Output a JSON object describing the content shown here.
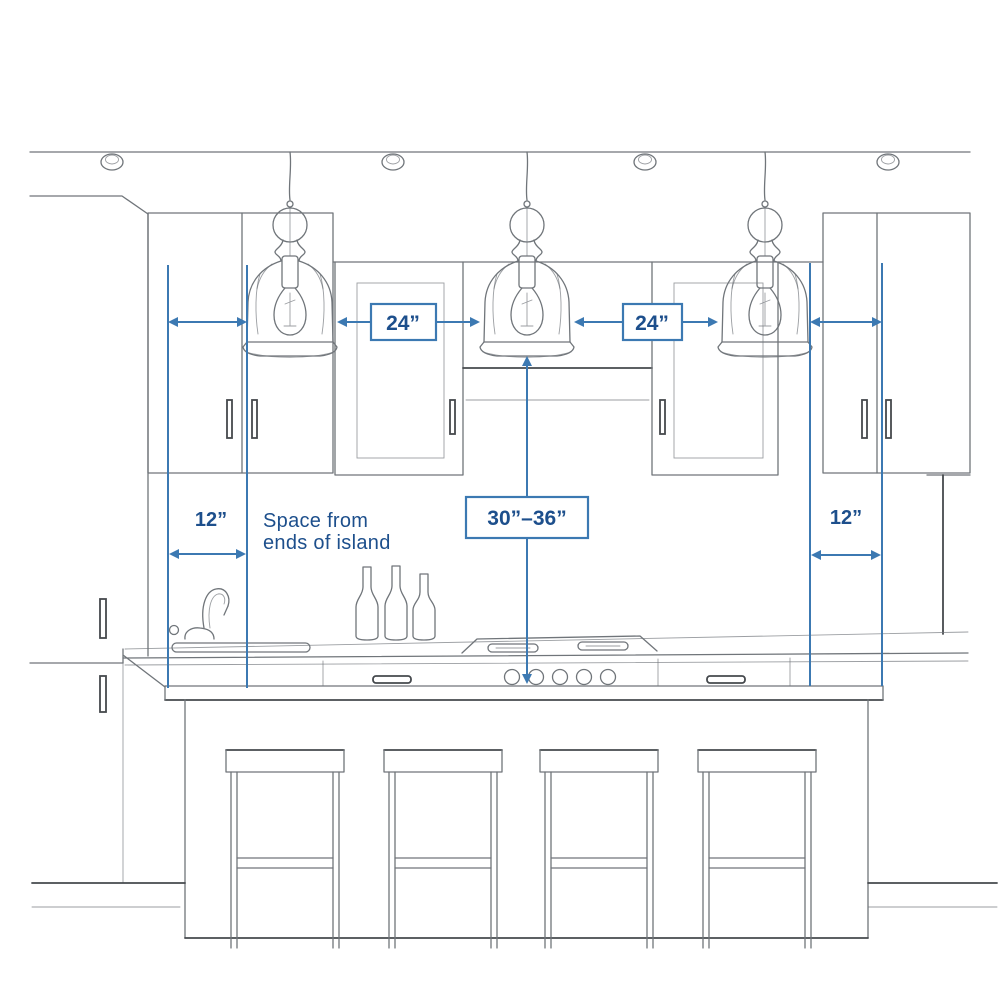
{
  "labels": {
    "spacing_left": "24”",
    "spacing_right": "24”",
    "end_offset_left": "12”",
    "end_offset_right": "12”",
    "hang_height": "30”–36”",
    "note_line1": "Space from",
    "note_line2": "ends of island"
  },
  "colors": {
    "annotation_line": "#3c79b2",
    "annotation_text": "#1d4f8c",
    "box_fill": "#ffffff",
    "sketch_line": "#70757a",
    "sketch_dark": "#45494d",
    "background": "#ffffff"
  },
  "scene": {
    "pendant_lights": 3,
    "recessed_ceiling_lights": 4,
    "bar_stools": 4,
    "wine_bottles": 3,
    "cooktop_knobs": 5
  }
}
